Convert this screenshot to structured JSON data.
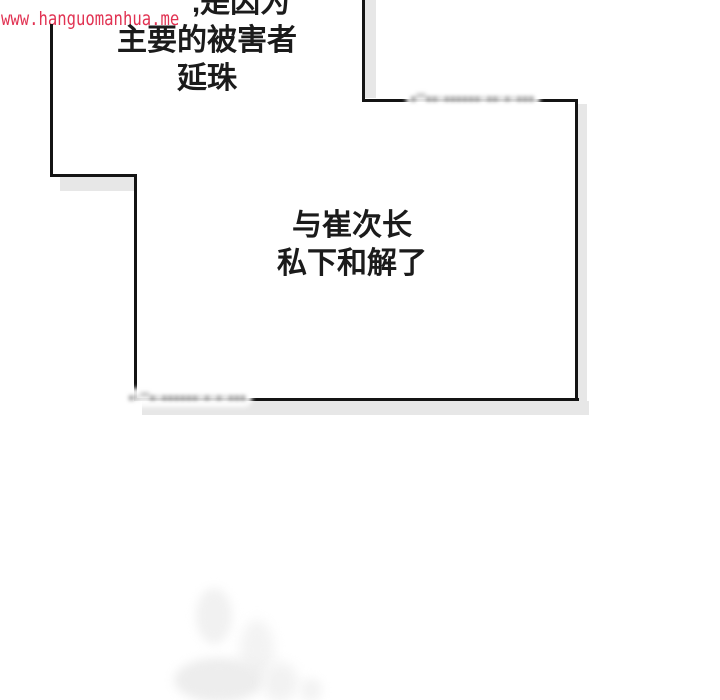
{
  "watermark": {
    "text": "www.hanguomanhua.me",
    "color": "#e13252"
  },
  "bubbles": {
    "top": {
      "lines": [
        ",是因为",
        "主要的被害者",
        "延珠"
      ]
    },
    "panel": {
      "lines": [
        "与崔次长",
        "私下和解了"
      ]
    }
  },
  "censored": {
    "top_right": "▪''▪▪·▪▪▪▪▪▪·▪▪·▪·▪▪▪",
    "bottom_left": "▪·''▪·▪▪▪▪▪▪·▪·▪·▪▪▪"
  },
  "colors": {
    "background": "#ffffff",
    "panel_line": "#141414",
    "panel_shadow": "#e7e7e7",
    "text": "#1b1b1b",
    "watermark": "#e13252"
  }
}
